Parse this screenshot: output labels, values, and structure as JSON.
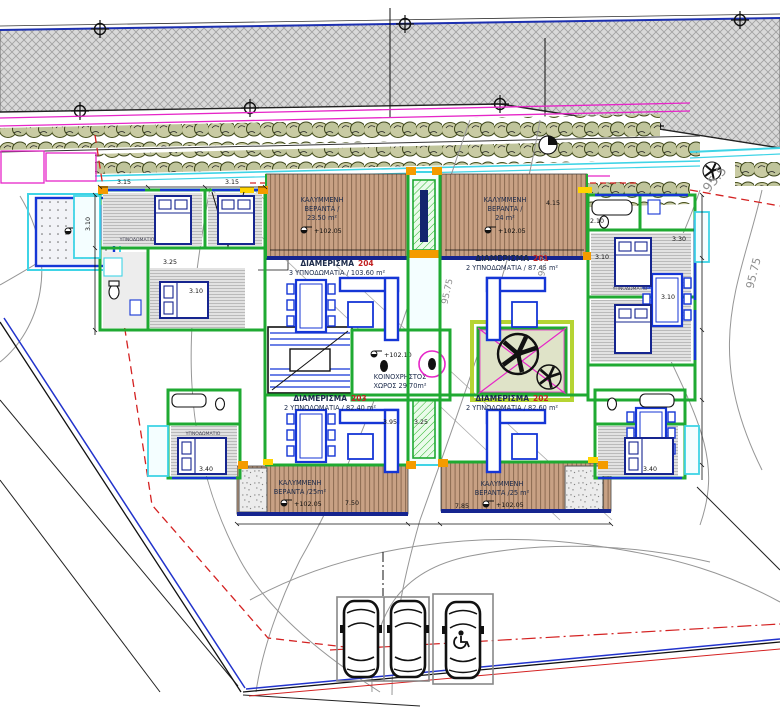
{
  "apartments": {
    "a204": {
      "title": "ΔΙΑΜΕΡΙΣΜΑ",
      "number": "204",
      "details": "3 ΥΠΝΟΔΩΜΑΤΙΑ / 103.60 m²"
    },
    "a201": {
      "title": "ΔΙΑΜΕΡΙΣΜΑ",
      "number": "201",
      "details": "2 ΥΠΝΟΔΩΜΑΤΙΑ / 87.45 m²"
    },
    "a203": {
      "title": "ΔΙΑΜΕΡΙΣΜΑ",
      "number": "203",
      "details": "2 ΥΠΝΟΔΩΜΑΤΙΑ / 82.40 m²"
    },
    "a202": {
      "title": "ΔΙΑΜΕΡΙΣΜΑ",
      "number": "202",
      "details": "2 ΥΠΝΟΔΩΜΑΤΙΑ / 82.60 m²"
    }
  },
  "verandas": {
    "top_left": {
      "l1": "ΚΑΛΥΜΜΕΝΗ",
      "l2": "ΒΕΡΑΝΤΑ /",
      "l3": "23.50 m²",
      "level": "+102.05"
    },
    "top_right": {
      "l1": "ΚΑΛΥΜΜΕΝΗ",
      "l2": "ΒΕΡΑΝΤΑ /",
      "l3": "24 m²",
      "level": "+102.05"
    },
    "bottom_left": {
      "l1": "ΚΑΛΥΜΜΕΝΗ",
      "l2": "ΒΕΡΑΝΤΑ /25m²",
      "level": "+102.05"
    },
    "bottom_right": {
      "l1": "ΚΑΛΥΜΜΕΝΗ",
      "l2": "ΒΕΡΑΝΤΑ /25 m²",
      "level": "+102.05"
    }
  },
  "common_area": {
    "l1": "ΚΟΙΝΟΧΡΗΣΤΟΣ",
    "l2": "ΧΩΡΟΣ 29.70m²",
    "level": "+102.10"
  },
  "site": {
    "pad_level": "+90.45",
    "contours": {
      "c1": "95.5",
      "c2": "95.75",
      "c3": "94.75",
      "c4": "95.75"
    }
  },
  "rooms": {
    "bedroom": "ΥΠΝΟΔΩΜΑΤΙΟ"
  },
  "dimensions": {
    "d315a": "3.15",
    "d315b": "3.15",
    "d310a": "3.10",
    "d310b": "3.10",
    "d310c": "3.10",
    "d310d": "3.10",
    "d325a": "3.25",
    "d325b": "3.25",
    "d340a": "3.40",
    "d340b": "3.40",
    "d210": "2.10",
    "d330": "3.30",
    "d395": "3.95",
    "d415": "4.15",
    "d750": "7.50",
    "d785": "7.85"
  },
  "colors": {
    "wall_green": "#1faa32",
    "furniture_blue": "#1536d6",
    "deck_navy": "#16258f",
    "wood": "#c9a386",
    "boundary_red": "#d42222",
    "magenta": "#e626c8",
    "cyan": "#3fd4e6",
    "orange": "#f49b00",
    "lime": "#b6d433",
    "apartment_number_red": "#c22222"
  }
}
